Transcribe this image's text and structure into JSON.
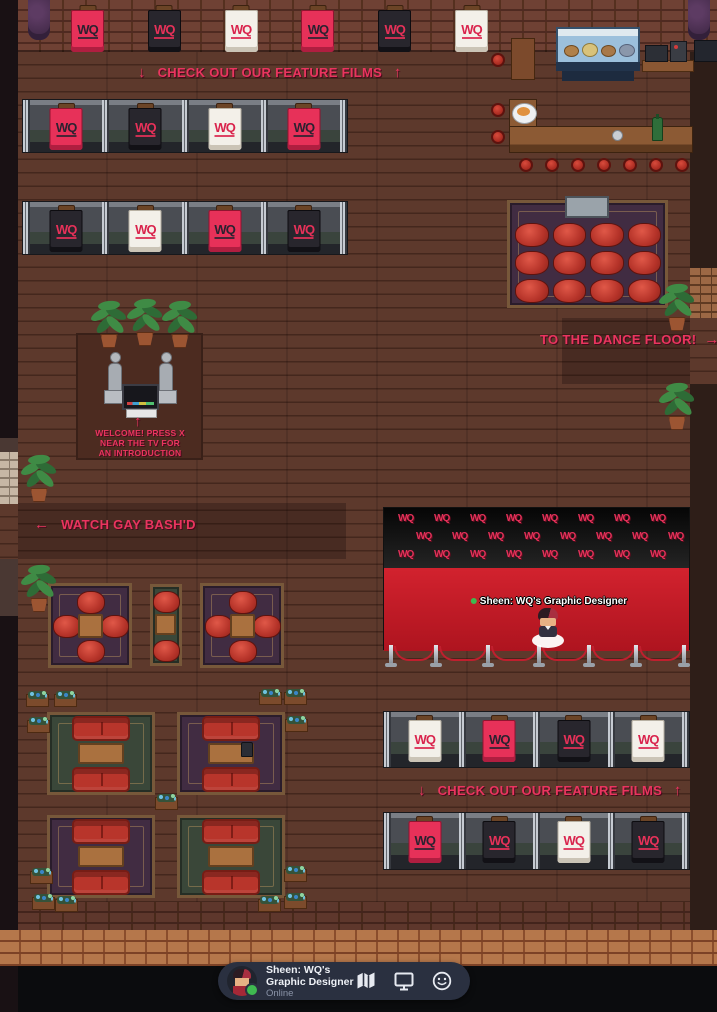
{
  "signs": {
    "top": {
      "down": "↓",
      "text": "CHECK OUT OUR FEATURE FILMS",
      "up": "↑"
    },
    "dance": {
      "text": "TO THE DANCE FLOOR!",
      "arrow": "→"
    },
    "watch": {
      "arrow": "←",
      "text": "WATCH GAY BASH'D"
    },
    "welcome": {
      "arrow": "↑",
      "line1": "WELCOME! PRESS X",
      "line2": "NEAR THE TV FOR",
      "line3": "AN INTRODUCTION"
    },
    "bottom": {
      "down": "↓",
      "text": "CHECK OUT OUR FEATURE FILMS",
      "up": "↑"
    }
  },
  "logo": {
    "text": "WQ"
  },
  "banners": {
    "top_wall": [
      "pink",
      "dark",
      "white",
      "pink",
      "dark",
      "white"
    ],
    "row_a": [
      "pink",
      "dark",
      "white",
      "pink"
    ],
    "row_b": [
      "dark",
      "white",
      "pink",
      "dark"
    ],
    "row_c": [
      "white",
      "pink",
      "dark",
      "white"
    ],
    "row_d": [
      "pink",
      "dark",
      "white",
      "dark"
    ]
  },
  "press_wall": {
    "logo": "WQ",
    "rows": 3,
    "per_row": 8
  },
  "player": {
    "name": "Sheen: WQ's Graphic Designer",
    "status": "Online",
    "overhead": "Sheen: WQ's Graphic Designer"
  },
  "toolbar": {
    "icons": [
      "map",
      "screen-share",
      "emoji"
    ]
  },
  "colors": {
    "accent_pink": "#e9355f",
    "banner_pink": "#e73159",
    "banner_dark": "#28262d",
    "banner_white": "#f3f0e9",
    "carpet_red": "#d2222e",
    "online_green": "#3fb950",
    "toolbar_bg": "#2a3040"
  }
}
